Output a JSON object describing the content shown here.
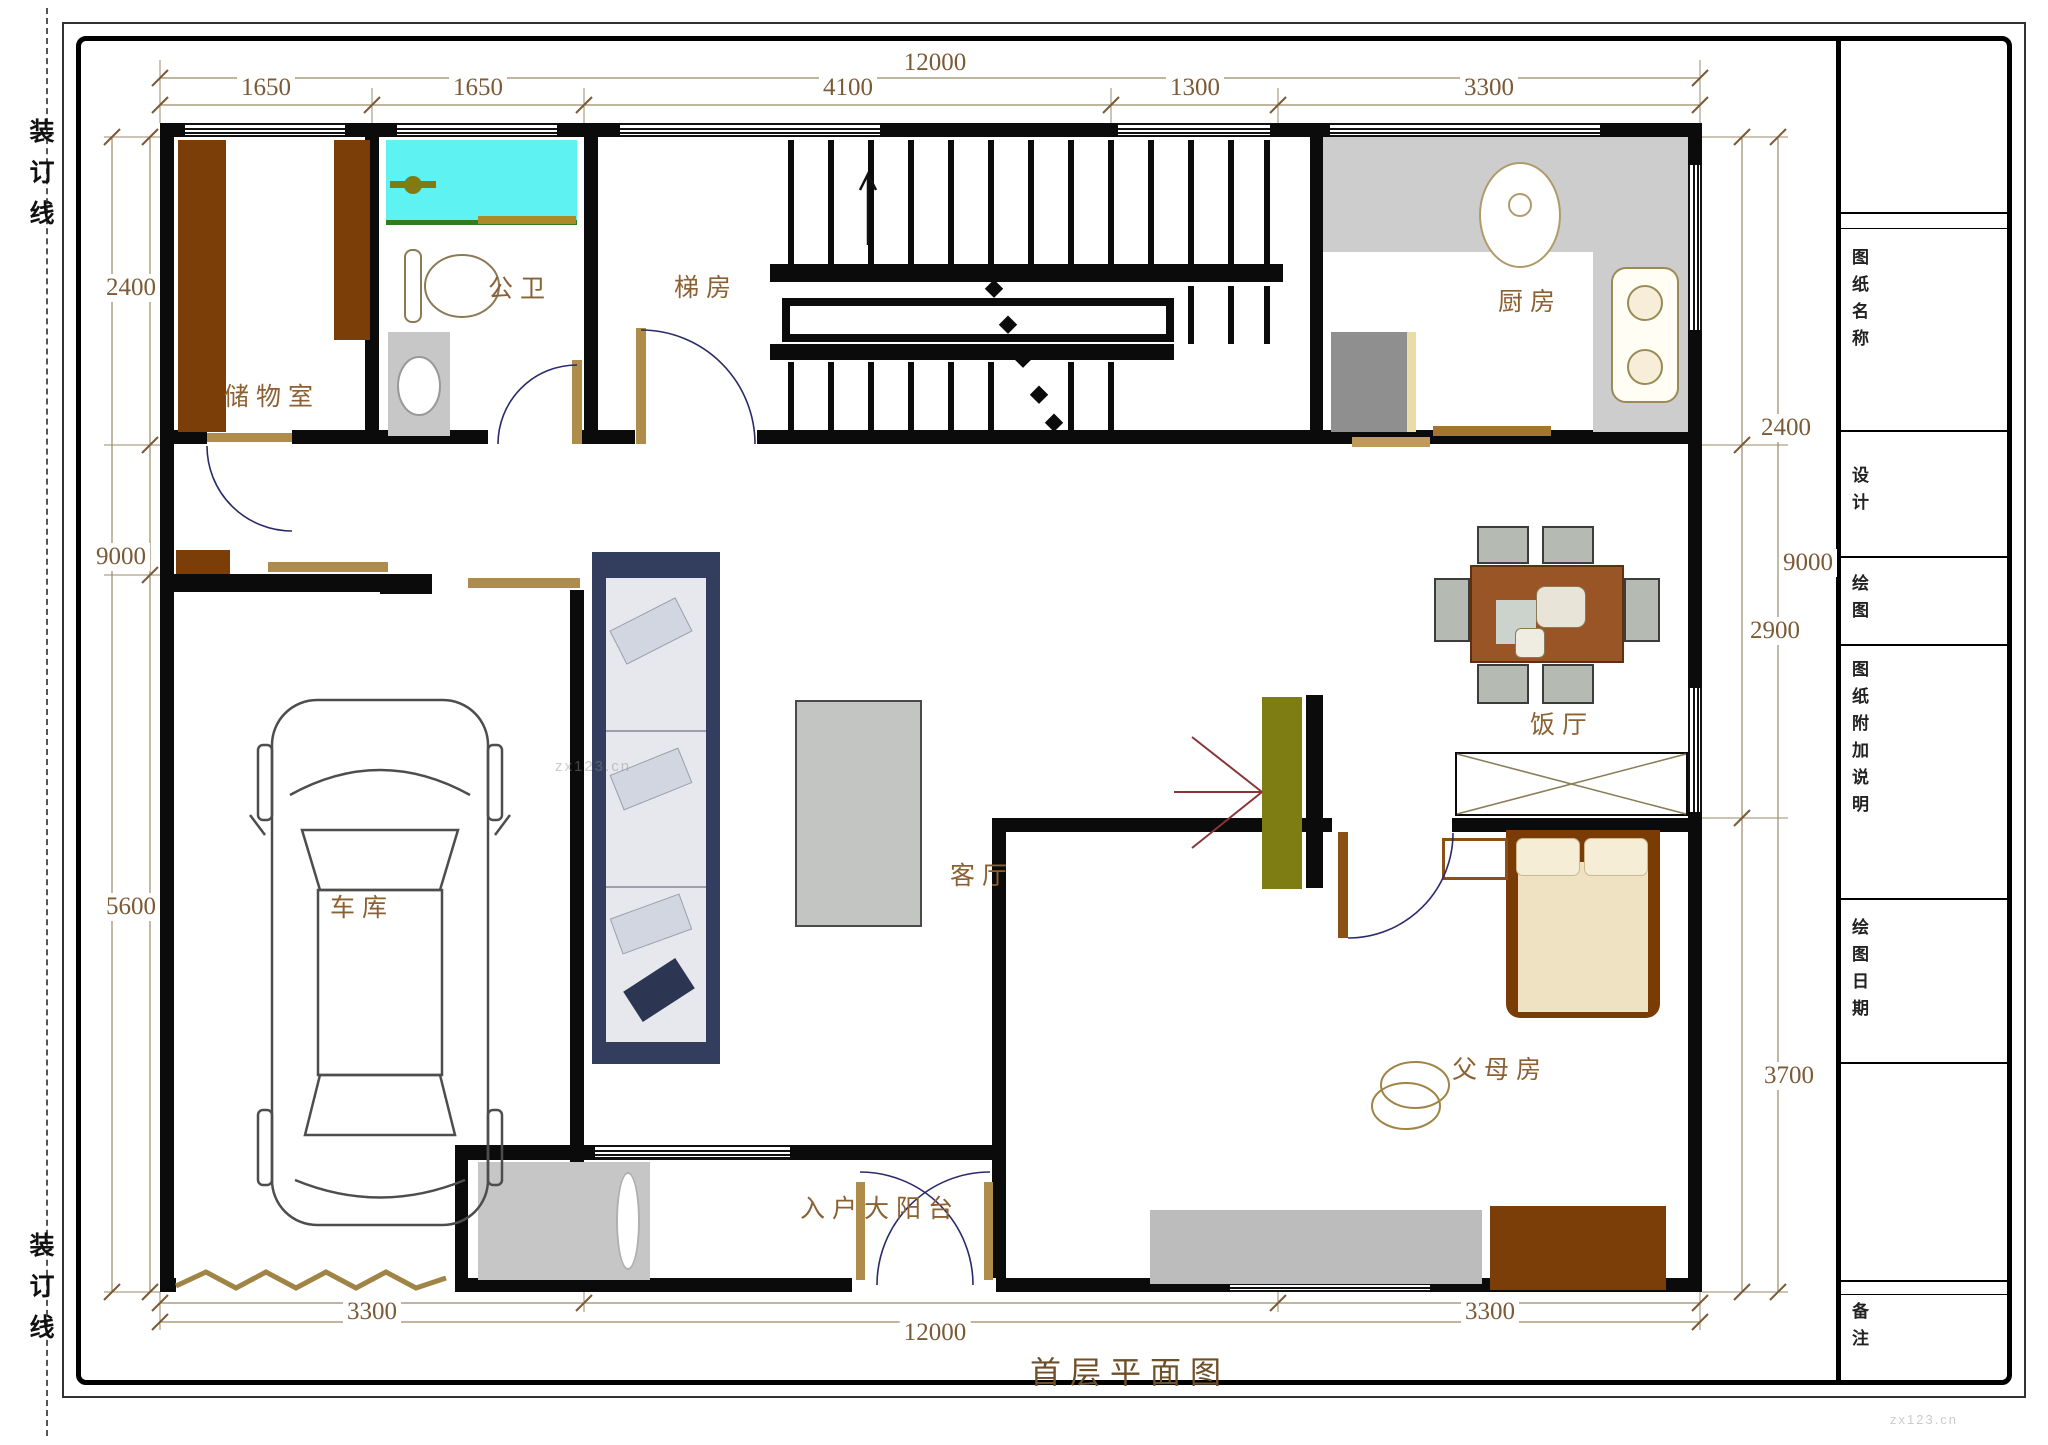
{
  "sheet": {
    "binding_label_top": "装订线",
    "binding_label_bottom": "装订线",
    "plan_title": "首层平面图",
    "watermark_center": "zx123.cn",
    "watermark_corner": "zx123.cn"
  },
  "title_block": {
    "labels": [
      "图纸名称",
      "设计",
      "绘图",
      "图纸附加说明",
      "绘图日期",
      "备注"
    ]
  },
  "rooms": {
    "storage": "储物室",
    "bathroom": "公卫",
    "stair": "梯房",
    "kitchen": "厨房",
    "dining": "饭厅",
    "living": "客厅",
    "garage": "车库",
    "balcony": "入户大阳台",
    "parents": "父母房"
  },
  "dimensions": {
    "top_total": "12000",
    "top_segments": [
      "1650",
      "1650",
      "4100",
      "1300",
      "3300"
    ],
    "left": [
      "2400",
      "9000",
      "5600"
    ],
    "right": [
      "2400",
      "9000",
      "2900",
      "3700"
    ],
    "bottom": [
      "3300",
      "12000",
      "3300"
    ]
  }
}
